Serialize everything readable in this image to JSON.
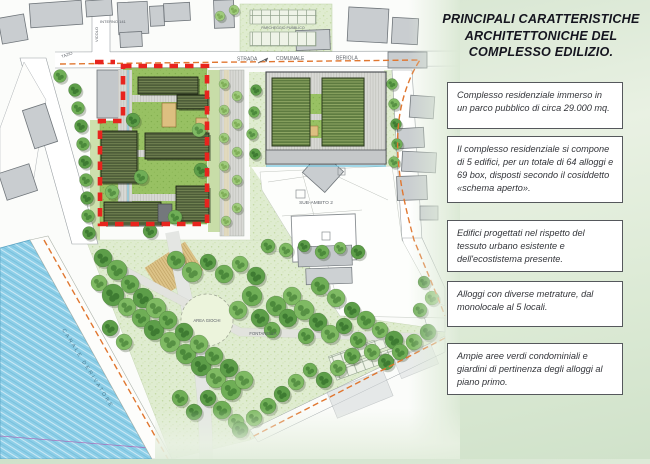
{
  "title": "PRINCIPALI CARATTERISTICHE ARCHITETTONICHE DEL COMPLESSO EDILIZIO.",
  "info_boxes": [
    {
      "text": "Complesso residenziale immerso in un parco pubblico di circa 29.000 mq."
    },
    {
      "text": "Il complesso residenziale si compone di 5 edifici, per un totale di 64 alloggi e 69 box, disposti secondo il cosiddetto «schema aperto»."
    },
    {
      "text": "Edifici progettati nel rispetto del tessuto urbano esistente e dell'ecostistema presente."
    },
    {
      "text": "Alloggi con diverse metrature, dal monolocale al 5 locali."
    },
    {
      "text": "Ampie aree verdi condominiali e giardini di pertinenza degli alloggi al piano primo."
    }
  ],
  "map_labels": {
    "street_a": "STRADA",
    "street_b": "COMUNALE",
    "street_c": "BERIOLA",
    "interno": "INTERNO 141",
    "vicolo": "VICOLO",
    "tazio": "TAZIO",
    "parcheggio": "PARCHEGGIO PUBBLICO",
    "sub_ambito": "SUB-AMBITO 2",
    "area_giochi": "AREA GIOCHI",
    "fontanella": "FONTANELLA",
    "canale": "CANALE DERIVATORE"
  },
  "colors": {
    "boundary_red": "#e8241e",
    "boundary_orange": "#e0762f",
    "canal_blue": "#8ecfe8",
    "lawn_green": "#98c163",
    "park_green": "#dfecd0",
    "new_building": "#4d5c38",
    "existing_building": "#c9cdd0"
  }
}
